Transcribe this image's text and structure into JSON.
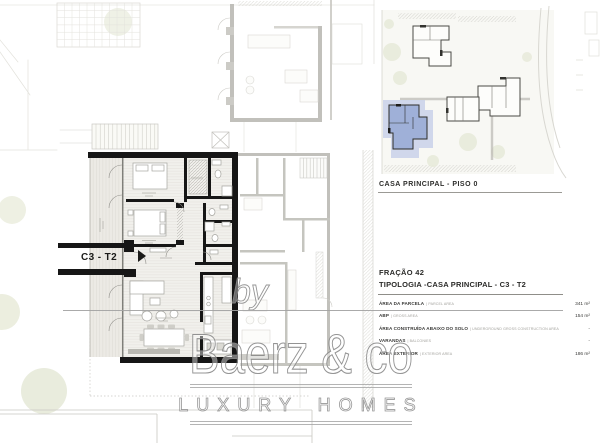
{
  "plan": {
    "unit_label": "C3 - T2",
    "accent_wall_color": "#161616"
  },
  "site_plan": {
    "caption": "CASA PRINCIPAL - PISO 0",
    "highlight_color": "#9fb0d8"
  },
  "details": {
    "fraction": "FRAÇÃO 42",
    "typology": "TIPOLOGIA -CASA PRINCIPAL - C3 - T2"
  },
  "areas": {
    "rows": [
      {
        "pt": "ÁREA DA PARCELA",
        "en": "| PARCEL AREA",
        "value": "341 m²"
      },
      {
        "pt": "ABP",
        "en": "| GROSS AREA",
        "value": "154 m²"
      },
      {
        "pt": "ÁREA CONSTRUÍDA ABAIXO DO SOLO",
        "en": "| UNDERGROUND GROSS CONSTRUCTION AREA",
        "value": "-"
      },
      {
        "pt": "VARANDAS",
        "en": "| BALCONIES",
        "value": "-"
      },
      {
        "pt": "ÁREA EXTERIOR",
        "en": "| EXTERIOR AREA",
        "value": "186 m²"
      }
    ]
  },
  "watermark": {
    "by": "by",
    "brand": "Baerz & co",
    "tagline": "LUXURY HOMES"
  }
}
